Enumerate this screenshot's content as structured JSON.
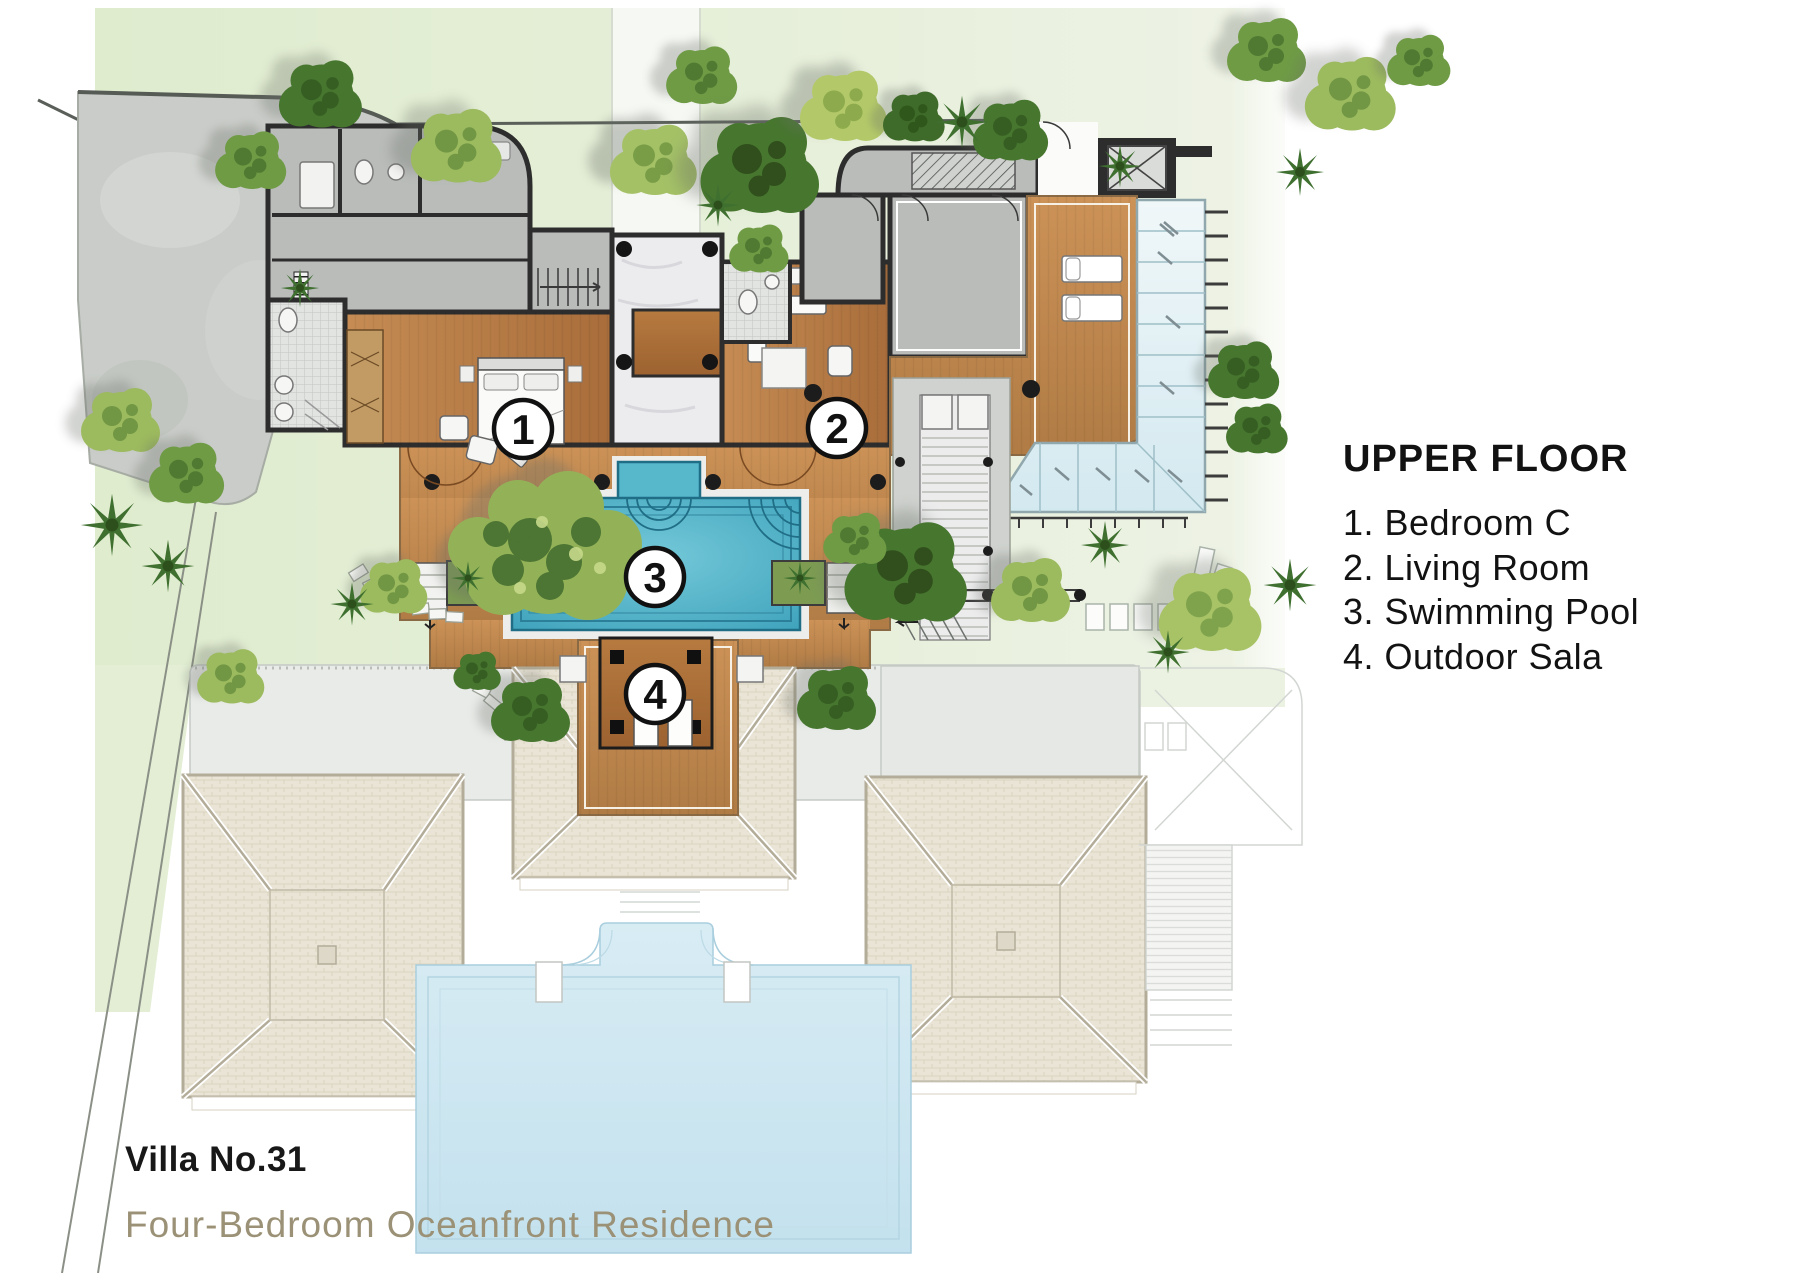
{
  "legend": {
    "title": "UPPER FLOOR",
    "items": [
      "1. Bedroom C",
      "2. Living Room",
      "3. Swimming Pool",
      "4. Outdoor Sala"
    ]
  },
  "markers": [
    "1",
    "2",
    "3",
    "4"
  ],
  "footer": {
    "title": "Villa No.31",
    "subtitle": "Four-Bedroom Oceanfront Residence"
  },
  "colors": {
    "accent_text": "#9b9176",
    "wall": "#2d2d2d",
    "wood_floor": "#b87c45",
    "deck_wood": "#c08a52",
    "swimming_pool": "#4fb0c7",
    "lower_pool": "#cfe7f1",
    "green_wash": "#e4eed7",
    "roof_beige": "#e9e3d5",
    "glass_roof": "#e2f0f4",
    "room_gray": "#b9bcb9",
    "driveway_gray": "#c9ccc8"
  }
}
